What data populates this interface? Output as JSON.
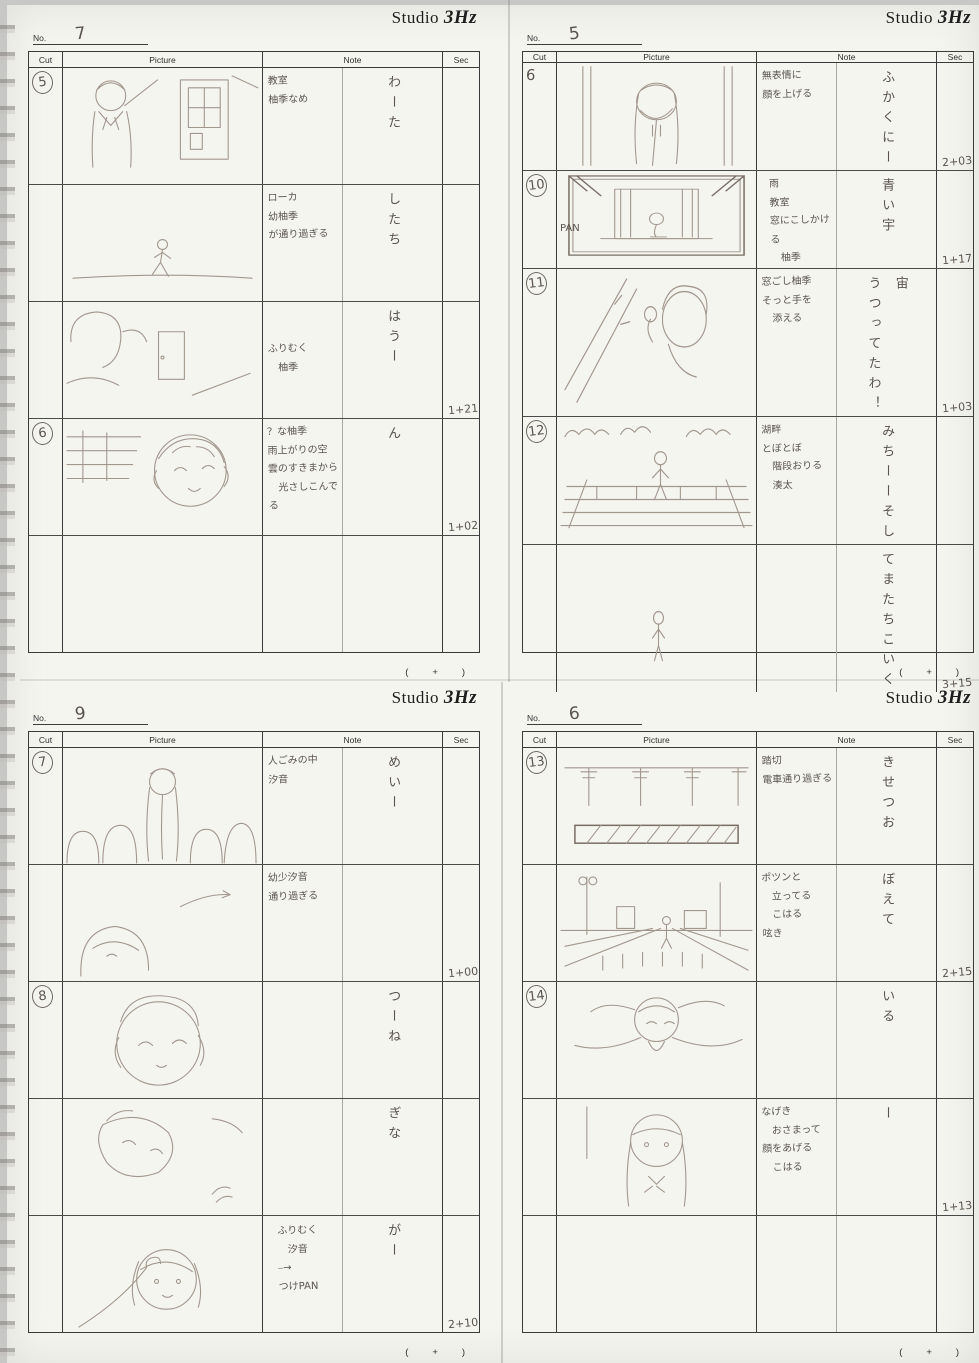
{
  "logo": {
    "studio": "Studio",
    "suffix": "3Hz"
  },
  "labels": {
    "no": "No.",
    "cut": "Cut",
    "picture": "Picture",
    "note": "Note",
    "sec": "Sec",
    "footer": "(   +   )"
  },
  "sheets": [
    {
      "page_no": "7",
      "rows": [
        {
          "cut": "5",
          "note": "教室\n柚季なめ",
          "dialogue": "わーた",
          "sec": ""
        },
        {
          "cut": "",
          "note": "ローカ\n幼柚季\nが通り過ぎる",
          "dialogue": "したち",
          "sec": ""
        },
        {
          "cut": "",
          "note": "ふりむく\n　柚季",
          "dialogue": "はうー",
          "sec": "1+21"
        },
        {
          "cut": "6",
          "note": "？な柚季\n雨上がりの空\n雲のすきまから\n　光さしこんでる",
          "dialogue": "ん",
          "sec": "1+02"
        },
        {
          "cut": "",
          "note": "",
          "dialogue": "",
          "sec": ""
        }
      ]
    },
    {
      "page_no": "5",
      "rows": [
        {
          "cut": "6",
          "note": "無表情に\n顔を上げる",
          "dialogue": "ふかくにー",
          "sec": "2+03"
        },
        {
          "cut": "10",
          "note": "雨\n教室\n窓にこしかける\n　柚季",
          "dialogue": "青い宇",
          "sec": "1+17",
          "pan": "PAN"
        },
        {
          "cut": "11",
          "note": "窓ごし柚季\nそっと手を\n　添える",
          "dialogue": "宙\nうつってたわ！",
          "sec": "1+03"
        },
        {
          "cut": "12",
          "note": "湖畔\nとぼとぼ\n　階段おりる\n　湊太",
          "dialogue": "みちーーそし",
          "sec": ""
        },
        {
          "cut": "",
          "note": "",
          "dialogue": "てまたちこいく",
          "sec": "3+15"
        }
      ]
    },
    {
      "page_no": "9",
      "rows": [
        {
          "cut": "7",
          "note": "人ごみの中\n汐音",
          "dialogue": "めいー",
          "sec": ""
        },
        {
          "cut": "",
          "note": "幼少汐音\n通り過ぎる",
          "dialogue": "",
          "sec": "1+00"
        },
        {
          "cut": "8",
          "note": "",
          "dialogue": "つーね",
          "sec": ""
        },
        {
          "cut": "",
          "note": "",
          "dialogue": "ぎな",
          "sec": ""
        },
        {
          "cut": "",
          "note": "ふりむく\n　汐音\n⎯→\nつけPAN",
          "dialogue": "がー",
          "sec": "2+10"
        }
      ]
    },
    {
      "page_no": "6",
      "rows": [
        {
          "cut": "13",
          "note": "踏切\n電車通り過ぎる",
          "dialogue": "きせつお",
          "sec": ""
        },
        {
          "cut": "",
          "note": "ポツンと\n　立ってる\n　こはる\n呟き",
          "dialogue": "ぼえて",
          "sec": "2+15"
        },
        {
          "cut": "14",
          "note": "",
          "dialogue": "いる",
          "sec": ""
        },
        {
          "cut": "",
          "note": "なげき\n　おさまって\n顔をあげる\n　こはる",
          "dialogue": "ー",
          "sec": "1+13"
        },
        {
          "cut": "",
          "note": "",
          "dialogue": "",
          "sec": ""
        }
      ]
    }
  ]
}
